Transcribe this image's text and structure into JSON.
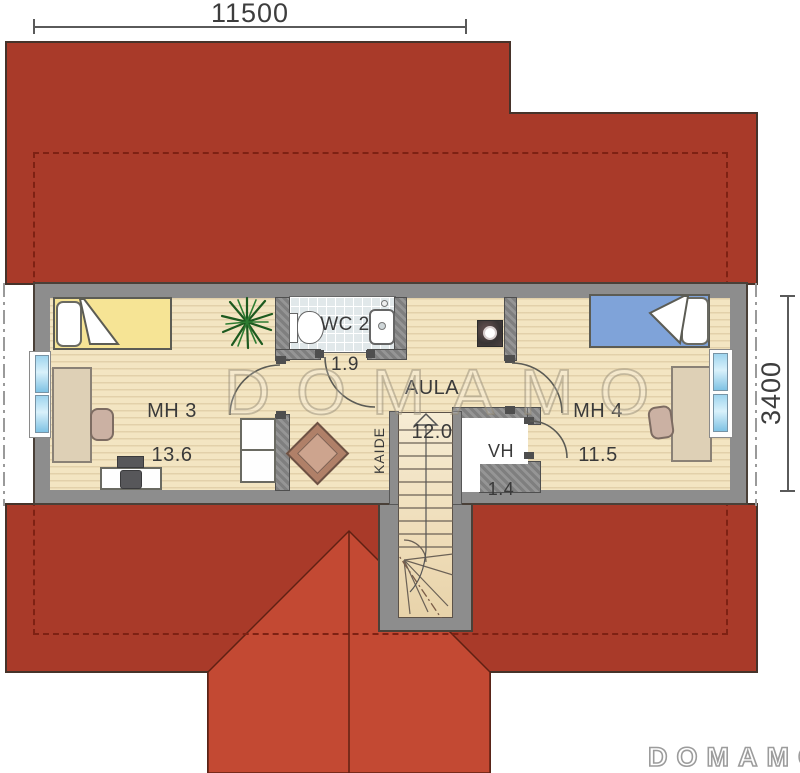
{
  "dimensions": {
    "top_width": "11500",
    "right_height": "3400"
  },
  "rooms": {
    "mh3": {
      "name": "MH 3",
      "area": "13.6"
    },
    "wc2": {
      "name": "WC 2",
      "area": "1.9"
    },
    "aula": {
      "name": "AULA",
      "area": "12.0"
    },
    "vh": {
      "name": "VH",
      "area": "1.4"
    },
    "mh4": {
      "name": "MH 4",
      "area": "11.5"
    }
  },
  "stairs": {
    "label": "KAIDE"
  },
  "watermark": {
    "text": "DOMAMO"
  },
  "logo": {
    "text": "DOMAMO"
  },
  "colors": {
    "roof_dark": "#a93a29",
    "roof_light": "#c34933",
    "wall_gray": "#8d8d8d",
    "floor_cream": "#f3e5c2",
    "bed_yellow": "#f6e495",
    "bed_blue": "#7fa3d9",
    "window_blue": "#9fd4ee"
  }
}
